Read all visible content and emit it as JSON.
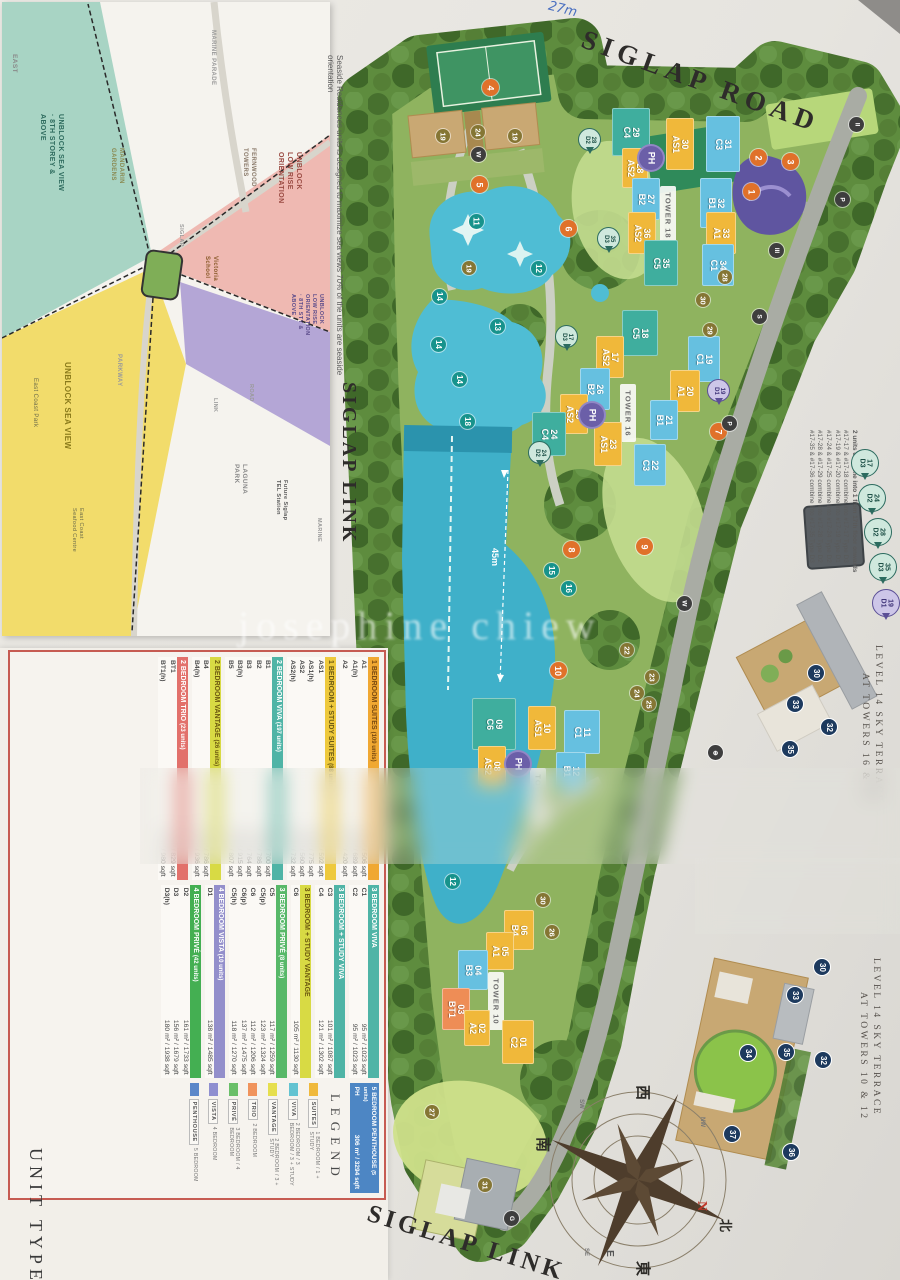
{
  "caption_side": "Seaside Residences units is designed to maximize sea views  70% of the units are seaside orientation",
  "siglap_link_side": "SIGLAP LINK",
  "watermark": "josephine chiew",
  "inset_map": {
    "east": "EAST",
    "zone_teal": "UNBLOCK SEA VIEW\n· 8TH STOREY &\nABOVE",
    "mandarin": "MANDARIN\nGARDENS",
    "marine_parade": "MARINE PARADE",
    "fernwood": "FERNWOOD\nTOWERS",
    "zone_pink": "UNBLOCK\nLOW RISE\nORIENTATION",
    "victoria": "Victoria\nSchool",
    "zone_purple": "UNBLOCK\nLOW RISE\nORIENTATION\n· 8TH STY &\nABOVE",
    "zone_yellow": "UNBLOCK SEA VIEW",
    "east_coast_park": "East Coast Park",
    "parkway": "PARKWAY",
    "road": "ROAD",
    "link": "LINK",
    "seafood": "East Coast\nSeafood Centre",
    "laguna": "LAGUNA\nPARK",
    "tel": "Future Siglap\nTEL Station",
    "marine": "MARINE",
    "siglap": "SIGLAP"
  },
  "plan": {
    "siglap_road": "SIGLAP ROAD",
    "siglap_link": "SIGLAP LINK",
    "pool_length": "45m",
    "handwriting": "27m",
    "towers": {
      "t18": "TOWER 18",
      "t16": "TOWER 16",
      "t12": "TOWER 12",
      "t10": "TOWER 10"
    },
    "ph": "PH",
    "units": [
      "29\nC4",
      "30\nAS1",
      "31\nC3",
      "28\nAS2",
      "27\nB2",
      "32\nB1",
      "36\nAS2",
      "33\nA1",
      "35\nC5",
      "34\nC1",
      "18\nC5",
      "17\nAS2",
      "19\nC1",
      "26\nB2",
      "20\nA1",
      "25\nAS2",
      "21\nB1",
      "23\nAS1",
      "24\nC4",
      "22\nC3",
      "09\nC6",
      "10\nAS1",
      "11\nC1",
      "08\nAS2",
      "12\nB1",
      "06\nB4",
      "05\nA1",
      "04\nB3",
      "03\nBT1",
      "02\nA2",
      "01\nC2"
    ],
    "orange": [
      "1",
      "2",
      "3",
      "4",
      "5",
      "6",
      "7",
      "8",
      "9",
      "10"
    ],
    "teal": [
      "11",
      "12",
      "13",
      "14",
      "14",
      "14",
      "15",
      "16",
      "18",
      "12"
    ],
    "olive": [
      "19",
      "19",
      "19",
      "24",
      "22",
      "23",
      "24",
      "25",
      "26",
      "27",
      "28",
      "29",
      "30",
      "30",
      "31"
    ],
    "dark": [
      "W",
      "II",
      "III",
      "P",
      "S",
      "P",
      "W",
      "G",
      "⊕"
    ],
    "bubbles": [
      "28\nD2",
      "35\nD3",
      "17\nD3",
      "24\nD2",
      "19\nD1"
    ]
  },
  "notes": {
    "title": "2 units combine into 1 from 17th floor onwards",
    "lines": [
      "#17-17 & #17-18 combine into #17-17 Type D3",
      "#17-19 & #17-20 combine into #17-19 Type D1",
      "#17-24 & #17-25 combine into #17-24 Type D2",
      "#17-28 & #17-29 combine into #17-28 Type D2",
      "#17-35 & #17-36 combine into #17-35 Type D3"
    ],
    "pins": [
      "17\nD3",
      "24\nD2",
      "28\nD2",
      "35\nD3",
      "19\nD1"
    ]
  },
  "insets": {
    "a_line1": "LEVEL 14 SKY TERRACE",
    "a_line2": "AT TOWERS 16 & 18",
    "b_line1": "LEVEL 14 SKY TERRACE",
    "b_line2": "AT TOWERS 10 & 12",
    "navy_a": [
      "30",
      "33",
      "32",
      "35"
    ],
    "navy_b": [
      "30",
      "33",
      "34",
      "35",
      "32",
      "37",
      "36"
    ]
  },
  "compass": {
    "n": "N",
    "e": "E",
    "north_cn": "北",
    "south_cn": "南",
    "east_cn": "東",
    "west_cn": "西",
    "sw": "SW",
    "nw": "NW",
    "se": "SE"
  },
  "unit_table": {
    "title": "UNIT TYPES",
    "legend_title": "LEGEND",
    "groups_left": [
      {
        "name": "1 BEDROOM SUITES",
        "count": "(109 units)",
        "color": "#f0a832",
        "rows": [
          [
            "A1",
            "47 m² / 506 sqft"
          ],
          [
            "A1(h)",
            "64 m² / 689 sqft"
          ],
          [
            "A2",
            "39 m² / 420 sqft"
          ]
        ]
      },
      {
        "name": "1 BEDROOM + STUDY SUITES",
        "count": "(88 units)",
        "color": "#eec93c",
        "rows": [
          [
            "AS1",
            "55 m² / 592 sqft"
          ],
          [
            "AS1(h)",
            "72 m² / 775 sqft"
          ],
          [
            "AS2",
            "52 m² / 560 sqft"
          ],
          [
            "AS2(h)",
            "68 m² / 732 sqft"
          ]
        ]
      },
      {
        "name": "2 BEDROOM VIVA",
        "count": "(197 units)",
        "color": "#4fb4a6",
        "rows": [
          [
            "B1",
            "65 m² / 700 sqft"
          ],
          [
            "B2",
            "73 m² / 786 sqft"
          ],
          [
            "B3",
            "71 m² / 764 sqft"
          ],
          [
            "B3(h)",
            "85 m² / 915 sqft"
          ],
          [
            "B5",
            "75 m² / 807 sqft"
          ]
        ]
      },
      {
        "name": "2 BEDROOM VANTAGE",
        "count": "(26 units)",
        "color": "#d8da44",
        "rows": [
          [
            "B4",
            "73 m² / 786 sqft"
          ],
          [
            "B4(h)",
            "87 m² / 936 sqft"
          ]
        ]
      },
      {
        "name": "2 BEDROOM TRIO",
        "count": "(23 units)",
        "color": "#e2716b",
        "rows": [
          [
            "BT1",
            "77 m² / 829 sqft"
          ],
          [
            "BT1(h)",
            "91 m² / 980 sqft"
          ]
        ]
      }
    ],
    "groups_right": [
      {
        "name": "3 BEDROOM VIVA",
        "count": "",
        "color": "#4fb4a6",
        "rows": [
          [
            "C1",
            "95 m² / 1023 sqft"
          ],
          [
            "C2",
            "95 m² / 1023 sqft"
          ]
        ]
      },
      {
        "name": "3 BEDROOM + STUDY VIVA",
        "count": "",
        "color": "#4fb4a6",
        "rows": [
          [
            "C3",
            "101 m² / 1087 sqft"
          ],
          [
            "C4",
            "121 m² / 1302 sqft"
          ]
        ]
      },
      {
        "name": "3 BEDROOM + STUDY VANTAGE",
        "count": "",
        "color": "#d8da44",
        "rows": [
          [
            "C6",
            "105 m² / 1130 sqft"
          ]
        ]
      },
      {
        "name": "3 BEDROOM PRIVÉ",
        "count": "(8 units)",
        "color": "#57b868",
        "rows": [
          [
            "C5",
            "117 m² / 1259 sqft"
          ],
          [
            "C5(p)",
            "123 m² / 1324 sqft"
          ],
          [
            "C6",
            "112 m² / 1206 sqft"
          ],
          [
            "C6(p)",
            "137 m² / 1475 sqft"
          ],
          [
            "C5(h)",
            "118 m² / 1270 sqft"
          ]
        ]
      },
      {
        "name": "4 BEDROOM VISTA",
        "count": "(10 units)",
        "color": "#938fcb",
        "rows": [
          [
            "D1",
            "138 m² / 1485 sqft"
          ]
        ]
      },
      {
        "name": "4 BEDROOM PRIVÉ",
        "count": "(42 units)",
        "color": "#44af52",
        "rows": [
          [
            "D2",
            "161 m² / 1733 sqft"
          ],
          [
            "D3",
            "156 m² / 1679 sqft"
          ],
          [
            "D3(h)",
            "180 m² / 1938 sqft"
          ]
        ]
      }
    ],
    "penthouse": {
      "name": "5 BEDROOM PENTHOUSE",
      "count": "(5 units)",
      "type": "PH",
      "area": "306 m² / 3294 sqft",
      "color": "#4d86c4"
    },
    "legend": [
      {
        "name": "SUITES",
        "desc": "1 BEDROOM / 1 + STUDY",
        "color": "#f0b93c"
      },
      {
        "name": "VIVA",
        "desc": "2 BEDROOM / 3 BEDROOM / 3 + STUDY",
        "color": "#63c3d1"
      },
      {
        "name": "VANTAGE",
        "desc": "2 BEDROOM / 3 + STUDY",
        "color": "#e6df4e"
      },
      {
        "name": "TRIO",
        "desc": "2 BEDROOM",
        "color": "#f0935c"
      },
      {
        "name": "PRIVÉ",
        "desc": "3 BEDROOM / 4 BEDROOM",
        "color": "#6abf69"
      },
      {
        "name": "VISTA",
        "desc": "4 BEDROOM",
        "color": "#8f8fd0"
      },
      {
        "name": "PENTHOUSE",
        "desc": "5 BEDROOM",
        "color": "#5b87c9"
      }
    ]
  }
}
